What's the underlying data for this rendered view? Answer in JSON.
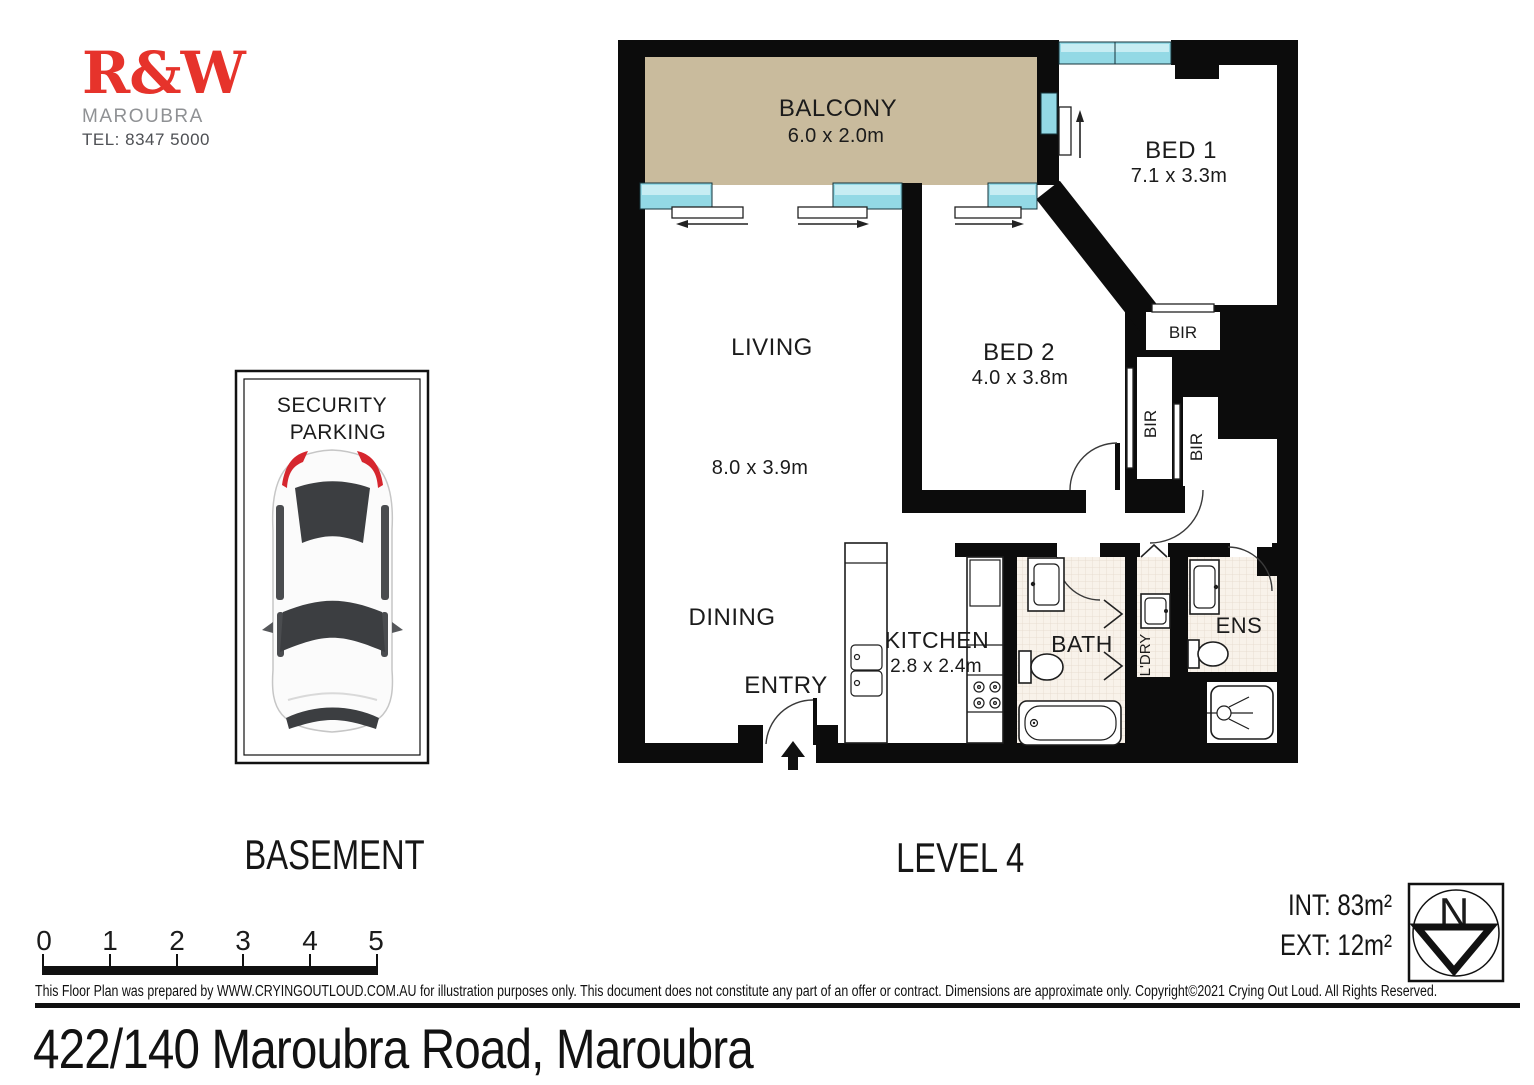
{
  "logo": {
    "brand": "R&W",
    "suburb": "MAROUBRA",
    "tel": "TEL: 8347 5000"
  },
  "plan": {
    "balcony": {
      "name": "BALCONY",
      "dims": "6.0 x 2.0m"
    },
    "bed1": {
      "name": "BED 1",
      "dims": "7.1 x 3.3m"
    },
    "bed2": {
      "name": "BED 2",
      "dims": "4.0 x 3.8m"
    },
    "living": {
      "name": "LIVING",
      "dims": "8.0 x 3.9m"
    },
    "dining": {
      "name": "DINING"
    },
    "entry": {
      "name": "ENTRY"
    },
    "kitchen": {
      "name": "KITCHEN",
      "dims": "2.8 x 2.4m"
    },
    "bath": {
      "name": "BATH"
    },
    "ldry": {
      "name": "L'DRY"
    },
    "ens": {
      "name": "ENS"
    },
    "bir": "BIR"
  },
  "parking": {
    "line1": "SECURITY",
    "line2": "PARKING"
  },
  "levels": {
    "basement": "BASEMENT",
    "level": "LEVEL 4"
  },
  "areas": {
    "int": "INT: 83m²",
    "ext": "EXT:  12m²"
  },
  "compass": {
    "n": "N"
  },
  "scalebar": {
    "ticks": [
      "0",
      "1",
      "2",
      "3",
      "4",
      "5"
    ]
  },
  "footer": {
    "disclaimer": "This Floor Plan was prepared by WWW.CRYINGOUTLOUD.COM.AU for illustration purposes only. This document does not constitute any part of an offer or contract. Dimensions are approximate only. Copyright©2021 Crying Out Loud. All Rights Reserved.",
    "address": "422/140 Maroubra Road, Maroubra"
  },
  "colors": {
    "brand_red": "#e6332b",
    "wall": "#0c0c0c",
    "balcony_floor": "#c9bb9d",
    "window_glass": "#93d9e5",
    "tile_floor": "#f8f2ea",
    "car_red": "#d6262e"
  }
}
